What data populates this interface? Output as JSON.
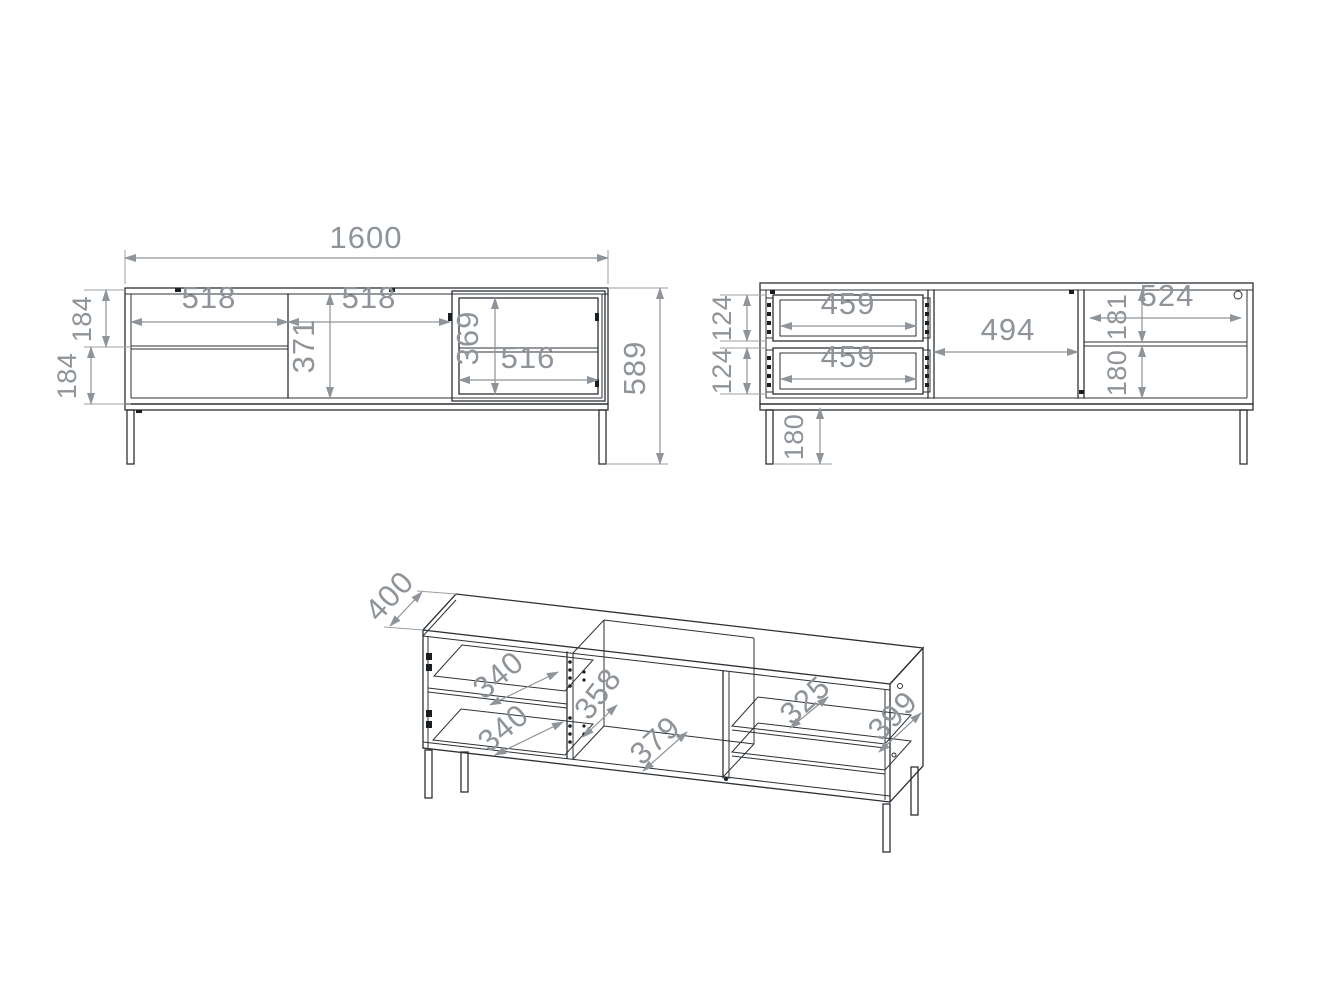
{
  "drawing": {
    "front_view": {
      "overall_width": "1600",
      "left_section_width": "518",
      "middle_door_width": "518",
      "middle_door_height": "371",
      "glass_section_height": "369",
      "glass_section_width": "516",
      "top_drawer_front_height": "184",
      "bottom_drawer_front_height": "184",
      "overall_height": "589"
    },
    "interior_view": {
      "top_drawer_box_height": "124",
      "bottom_drawer_box_height": "124",
      "top_drawer_box_width": "459",
      "bottom_drawer_box_width": "459",
      "middle_compartment_width": "494",
      "right_compartment_width": "524",
      "right_top_compartment_height": "181",
      "right_bottom_compartment_height": "180",
      "leg_height": "180"
    },
    "perspective_view": {
      "overall_depth": "400",
      "top_drawer_depth": "340",
      "bottom_drawer_depth": "340",
      "middle_compartment_height": "358",
      "middle_compartment_width": "379",
      "shelf_depth": "325",
      "side_panel_depth": "399"
    },
    "colors": {
      "furniture_line": "#2c3135",
      "dimension": "#8e9499",
      "background": "#ffffff"
    }
  }
}
